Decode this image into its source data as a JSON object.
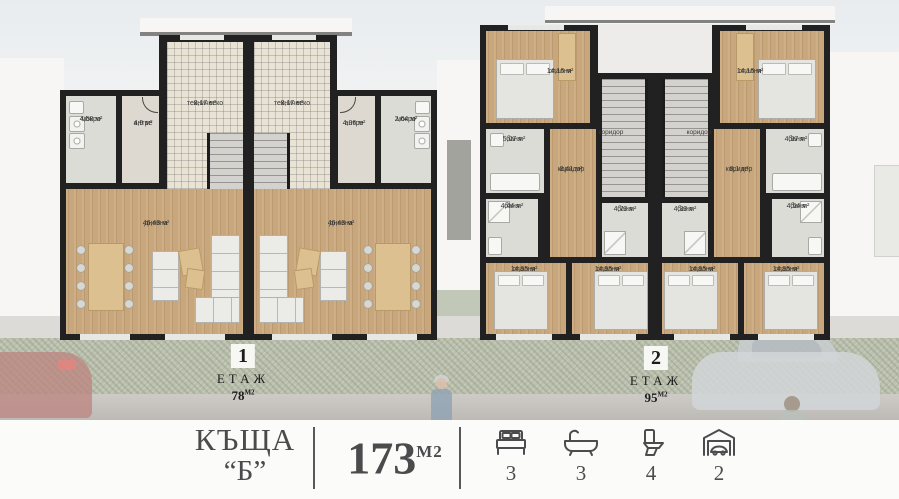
{
  "colors": {
    "wall": "#212121",
    "wood_floor": "#c9a77c",
    "footer_text": "#4b4b4e",
    "hedge_green": "#9aa287"
  },
  "floor1": {
    "badge": "1",
    "label": "ЕТАЖ",
    "area": "78",
    "area_unit": "М2",
    "units": [
      {
        "rooms": [
          {
            "name": "мокро",
            "area": "4,58 м²"
          },
          {
            "name": "антре",
            "area": "4,9 м²"
          },
          {
            "name": "техническо",
            "area": "8,17 м²"
          },
          {
            "name": "дневна",
            "area": "46,43 м²"
          }
        ]
      },
      {
        "rooms": [
          {
            "name": "техническо",
            "area": "8,17 м²"
          },
          {
            "name": "антре",
            "area": "4,06 м²"
          },
          {
            "name": "мокро",
            "area": "2,64 м²"
          },
          {
            "name": "дневна",
            "area": "46,43 м²"
          }
        ]
      }
    ]
  },
  "floor2": {
    "badge": "2",
    "label": "ЕТАЖ",
    "area": "95",
    "area_unit": "М2",
    "units": [
      {
        "rooms": [
          {
            "name": "спалня",
            "area": "14,16 м²"
          },
          {
            "name": "баня",
            "area": "5,07 м²"
          },
          {
            "name": "коридор",
            "area": ""
          },
          {
            "name": "коридор",
            "area": "8,41 м²"
          },
          {
            "name": "баня",
            "area": "4,44 м²"
          },
          {
            "name": "баня",
            "area": "4,73 м²"
          },
          {
            "name": "спалня",
            "area": "14,95 м²"
          },
          {
            "name": "спалня",
            "area": "14,95 м²"
          }
        ]
      },
      {
        "rooms": [
          {
            "name": "спалня",
            "area": "14,16 м²"
          },
          {
            "name": "баня",
            "area": "4,97 м²"
          },
          {
            "name": "коридор",
            "area": ""
          },
          {
            "name": "коридор",
            "area": "8,1 м²"
          },
          {
            "name": "баня",
            "area": "4,33 м²"
          },
          {
            "name": "баня",
            "area": "4,54 м²"
          },
          {
            "name": "спалня",
            "area": "14,95 м²"
          },
          {
            "name": "спалня",
            "area": "14,95 м²"
          }
        ]
      }
    ]
  },
  "footer": {
    "house_line1": "КЪЩА",
    "house_line2": "“Б”",
    "total_area": "173",
    "total_area_unit": "М2",
    "stats": [
      {
        "icon": "bed-icon",
        "count": "3"
      },
      {
        "icon": "bathtub-icon",
        "count": "3"
      },
      {
        "icon": "toilet-icon",
        "count": "4"
      },
      {
        "icon": "garage-icon",
        "count": "2"
      }
    ]
  }
}
